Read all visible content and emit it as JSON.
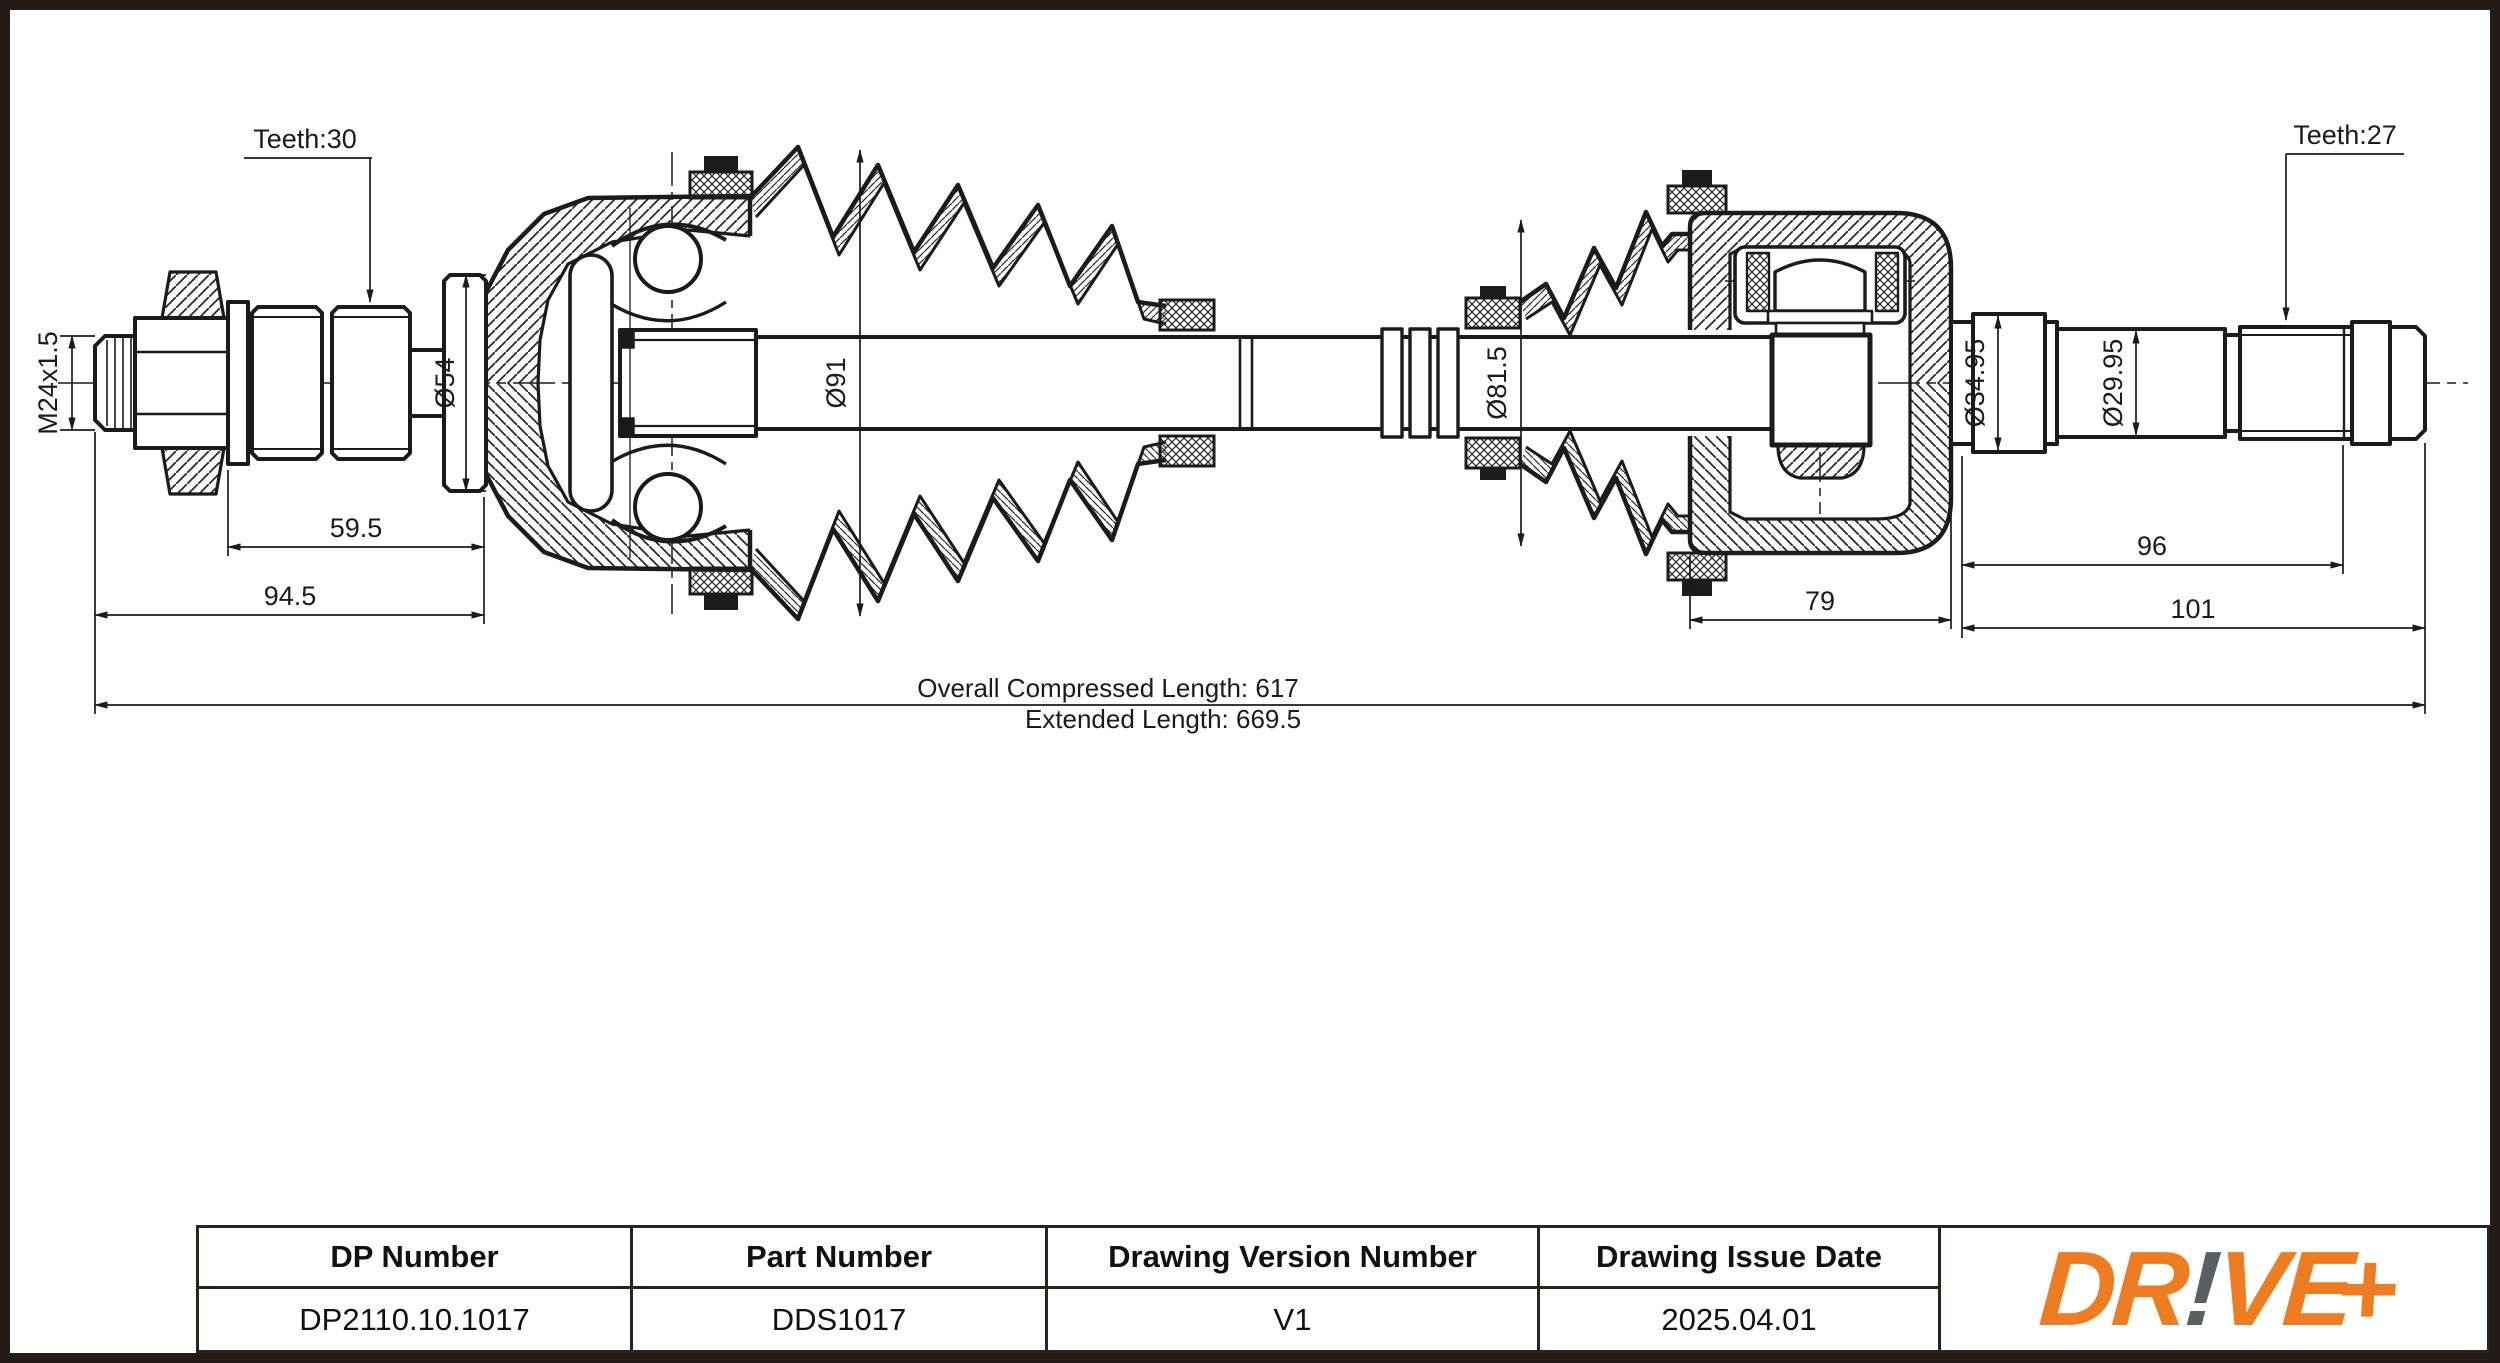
{
  "page": {
    "background": "#ffffff",
    "frame_color": "#241a16",
    "line_color": "#1b1b1b"
  },
  "drawing": {
    "labels": {
      "teeth_left": "Teeth:30",
      "teeth_right": "Teeth:27",
      "thread": "M24x1.5",
      "dia_54": "Ø54",
      "dia_91": "Ø91",
      "dia_81_5": "Ø81.5",
      "dia_34_95": "Ø34.95",
      "dia_29_95": "Ø29.95",
      "len_59_5": "59.5",
      "len_94_5": "94.5",
      "len_79": "79",
      "len_96": "96",
      "len_101": "101",
      "overall_compressed": "Overall  Compressed  Length: 617",
      "extended": "Extended  Length: 669.5"
    }
  },
  "title_block": {
    "columns": [
      {
        "header": "DP Number",
        "value": "DP2110.10.1017"
      },
      {
        "header": "Part Number",
        "value": "DDS1017"
      },
      {
        "header": "Drawing Version Number",
        "value": "V1"
      },
      {
        "header": "Drawing Issue Date",
        "value": "2025.04.01"
      }
    ],
    "logo": {
      "part1": "DR",
      "bang": "!",
      "part2": "VE",
      "plus": "+",
      "orange": "#EE7C21",
      "gray": "#5B5E62"
    }
  }
}
